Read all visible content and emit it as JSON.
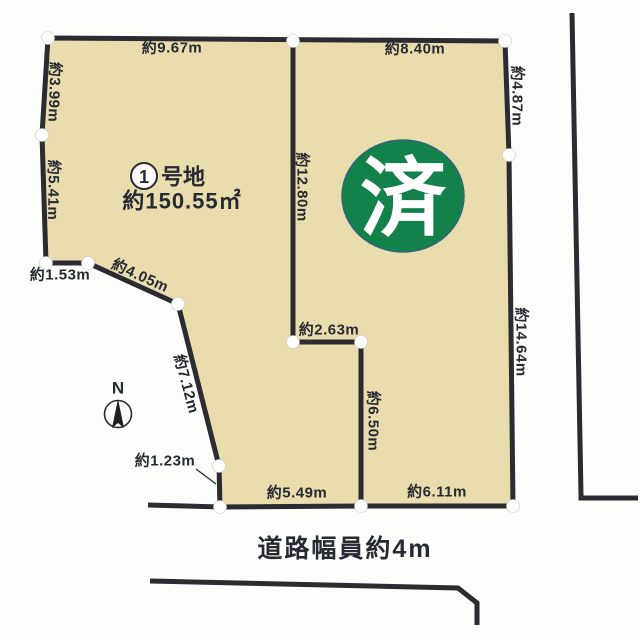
{
  "lot": {
    "number": "1",
    "suffix": "号地",
    "area": "約150.55㎡"
  },
  "stamp": {
    "text": "済",
    "color": "#12814a"
  },
  "compass": {
    "north": "N"
  },
  "road": {
    "label": "道路幅員約4m"
  },
  "edges": {
    "top_left": "約9.67m",
    "top_right": "約8.40m",
    "left_upper": "約3.99m",
    "left_lower": "約5.41m",
    "divider_vertical": "約12.80m",
    "right_upper": "約4.87m",
    "right_lower": "約14.64m",
    "divider_horizontal": "約2.63m",
    "divider_lower_vertical": "約6.50m",
    "notch_left": "約1.53m",
    "diagonal_upper": "約4.05m",
    "diagonal_lower": "約7.12m",
    "notch_vertical": "約1.23m",
    "bottom_left": "約5.49m",
    "bottom_right": "約6.11m"
  },
  "colors": {
    "lot_fill": "#e9dcad",
    "line": "#2b2b31",
    "text": "#252a33",
    "stamp_green": "#12814a",
    "background": "#fdfdfb"
  }
}
